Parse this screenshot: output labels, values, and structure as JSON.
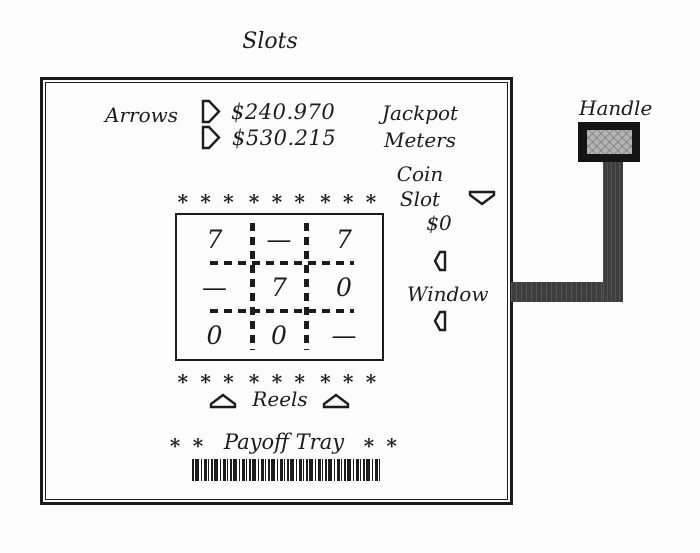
{
  "figure": {
    "title": "Slots",
    "handle_label": "Handle"
  },
  "machine": {
    "arrows_label": "Arrows",
    "jackpot": {
      "values": [
        "$240.970",
        "$530.215"
      ],
      "label": [
        "Jackpot",
        "Meters"
      ]
    },
    "coin_slot": {
      "label": [
        "Coin",
        "Slot"
      ],
      "value": "$0"
    },
    "window": {
      "label": "Window",
      "grid": [
        [
          "7",
          "—",
          "7"
        ],
        [
          "—",
          "7",
          "0"
        ],
        [
          "0",
          "0",
          "—"
        ]
      ]
    },
    "reels_label": "Reels",
    "asterisk_row": "∗ ∗ ∗",
    "payoff": {
      "label": "Payoff Tray",
      "side_asterisks": "∗ ∗"
    }
  },
  "colors": {
    "ink": "#1c1c1c",
    "paper": "#fdfdfd",
    "handle_metal": "#3e3e3e",
    "knob_outer": "#141414",
    "knob_grip": "#b4b4b4"
  }
}
